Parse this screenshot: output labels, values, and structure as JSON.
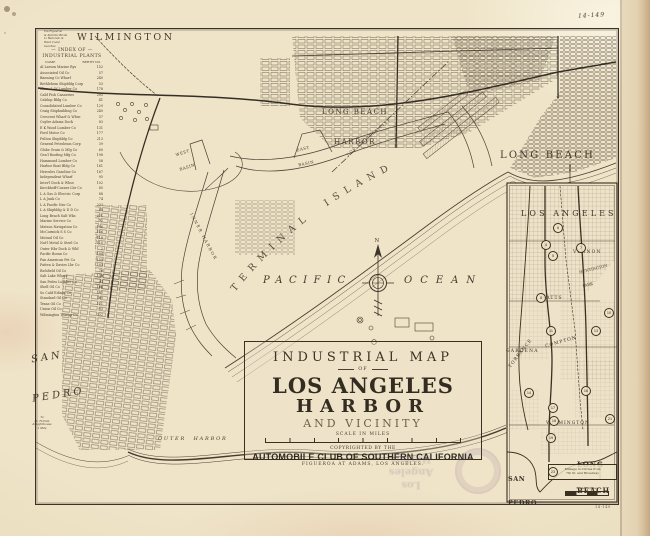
{
  "page": {
    "plate_number": "14-149",
    "pencil_mark": "14-149"
  },
  "labels": {
    "wilmington": "WILMINGTON",
    "long_beach_harbor_1": "LONG BEACH",
    "long_beach_harbor_2": "HARBOR",
    "long_beach": "LONG BEACH",
    "terminal_island": "TERMINAL ISLAND",
    "pacific": "PACIFIC",
    "ocean": "OCEAN",
    "san_pedro_1": "SAN",
    "san_pedro_2": "PEDRO",
    "west_basin_1": "WEST",
    "west_basin_2": "BASIN",
    "east_basin_1": "EAST",
    "east_basin_2": "BASIN",
    "inner_harbor": "INNER HARBOR",
    "outer_harbor": "OUTER HARBOR",
    "la_city_boundary": "LOS ANGELES CITY",
    "compass_north": "N"
  },
  "title_block": {
    "line1": "INDUSTRIAL MAP",
    "line2": "OF",
    "line3": "LOS ANGELES",
    "line4": "HARBOR",
    "line5": "AND VICINITY",
    "scale_label": "SCALE IN MILES",
    "copyright1": "COPYRIGHTED BY THE",
    "copyright2": "AUTOMOBILE CLUB OF SOUTHERN CALIFORNIA",
    "copyright3": "FIGUEROA AT ADAMS,  LOS ANGELES."
  },
  "index": {
    "title1": "— INDEX OF —",
    "title2": "INDUSTRIAL PLANTS",
    "col_name": "NAME",
    "col_berth": "BERTH NO.",
    "entries": [
      {
        "name": "Al Larson Marine Rys",
        "berth": "152"
      },
      {
        "name": "Associated Oil Co",
        "berth": "57"
      },
      {
        "name": "Banning Co Wharf",
        "berth": "240"
      },
      {
        "name": "Bethlehem Shipbldg Corp",
        "berth": "53"
      },
      {
        "name": "Blinn, L W Lumber Co",
        "berth": "178"
      },
      {
        "name": "Calif Fish Canneries",
        "berth": "205"
      },
      {
        "name": "Calship Bldg Co",
        "berth": "41"
      },
      {
        "name": "Consolidated Lumber Co",
        "berth": "129"
      },
      {
        "name": "Craig Shipbuilding Co",
        "berth": "240"
      },
      {
        "name": "Crescent Wharf & Whse",
        "berth": "57"
      },
      {
        "name": "Cuyler Adams Dock",
        "berth": "83"
      },
      {
        "name": "E K Wood Lumber Co",
        "berth": "131"
      },
      {
        "name": "Ford Motor Co",
        "berth": "177"
      },
      {
        "name": "Fulton Shipbldg Co",
        "berth": "213"
      },
      {
        "name": "General Petroleum Corp",
        "berth": "39"
      },
      {
        "name": "Globe Grain & Mlg Co",
        "berth": "60"
      },
      {
        "name": "Gen'l Roofing Mfg Co",
        "berth": "198"
      },
      {
        "name": "Hammond Lumber Co",
        "berth": "58"
      },
      {
        "name": "Harbor Boat Bldg Co",
        "berth": "161"
      },
      {
        "name": "Hercules Gasoline Co",
        "berth": "167"
      },
      {
        "name": "Independent Wharf",
        "berth": "95"
      },
      {
        "name": "Inter'l Dock & Whse",
        "berth": "102"
      },
      {
        "name": "Kerckhoff-Cuzner Lbr Co",
        "berth": "85"
      },
      {
        "name": "L A Gas & Electric Corp",
        "berth": "88"
      },
      {
        "name": "L A Junk Co",
        "berth": "74"
      },
      {
        "name": "L A Pacific Nav Co",
        "berth": "233"
      },
      {
        "name": "L A Shipbldg & D D Co",
        "berth": "45"
      },
      {
        "name": "Long Beach Salt Wks",
        "berth": "221"
      },
      {
        "name": "Marine Service Co",
        "berth": "72"
      },
      {
        "name": "Matson Navigation Co",
        "berth": "196"
      },
      {
        "name": "McCormick S S Co",
        "berth": "156"
      },
      {
        "name": "Mutual Oil Co",
        "berth": "118"
      },
      {
        "name": "Nat'l Metal & Steel Co",
        "berth": "210"
      },
      {
        "name": "Outer Hbr Dock & Whf",
        "berth": "2"
      },
      {
        "name": "Pacific Borax Co",
        "berth": "184"
      },
      {
        "name": "Pan American Pet Co",
        "berth": "150"
      },
      {
        "name": "Patten & Davies Lbr Co",
        "berth": "103"
      },
      {
        "name": "Richfield Oil Co",
        "berth": "76"
      },
      {
        "name": "Salt Lake Wharf",
        "berth": "138"
      },
      {
        "name": "San Pedro Lumber Co",
        "berth": "92"
      },
      {
        "name": "Shell Oil Co",
        "berth": "168"
      },
      {
        "name": "So Calif Edison Co",
        "berth": "107"
      },
      {
        "name": "Standard Oil Co",
        "berth": "160"
      },
      {
        "name": "Texas Oil Co",
        "berth": "121"
      },
      {
        "name": "Union Oil Co",
        "berth": "93"
      },
      {
        "name": "Wilmington Transp Co",
        "berth": "232"
      }
    ]
  },
  "notes": {
    "top_note_lines": [
      "Via Figueroa",
      "& Atlantic Blvds",
      "to Redondo &",
      "West Coast",
      "beaches"
    ],
    "sp_note_lines": [
      "To",
      "Pt. Fermin",
      "& Lighthouse",
      "1 Mile"
    ]
  },
  "inset": {
    "title": "LOS ANGELES",
    "vernon": "VERNON",
    "huntington_park_1": "HUNTINGTON",
    "huntington_park_2": "PARK",
    "watts": "WATTS",
    "gardena": "GARDENA",
    "compton": "COMPTON",
    "torrance": "TORRANCE",
    "wilmington": "WILMINGTON",
    "long_beach_1": "LONG",
    "long_beach_2": "BEACH",
    "san_pedro_1": "SAN",
    "san_pedro_2": "PEDRO",
    "note_line1": "Mileage in Circles from",
    "note_line2": "7th St. and Broadway",
    "scale_label": "Scale in Miles",
    "markers": [
      {
        "label": "6",
        "x": 557,
        "y": 227
      },
      {
        "label": "4",
        "x": 545,
        "y": 244
      },
      {
        "label": "5",
        "x": 552,
        "y": 255
      },
      {
        "label": "7",
        "x": 580,
        "y": 247
      },
      {
        "label": "8",
        "x": 540,
        "y": 297
      },
      {
        "label": "10",
        "x": 608,
        "y": 312
      },
      {
        "label": "11",
        "x": 550,
        "y": 330
      },
      {
        "label": "13",
        "x": 595,
        "y": 330
      },
      {
        "label": "14",
        "x": 528,
        "y": 392
      },
      {
        "label": "16",
        "x": 585,
        "y": 390
      },
      {
        "label": "17",
        "x": 552,
        "y": 407
      },
      {
        "label": "18",
        "x": 553,
        "y": 420
      },
      {
        "label": "21",
        "x": 609,
        "y": 418
      },
      {
        "label": "19",
        "x": 550,
        "y": 437
      },
      {
        "label": "23",
        "x": 552,
        "y": 471
      }
    ]
  },
  "stamp": {
    "line1": "Los Angeles",
    "line2": "Harbor"
  }
}
